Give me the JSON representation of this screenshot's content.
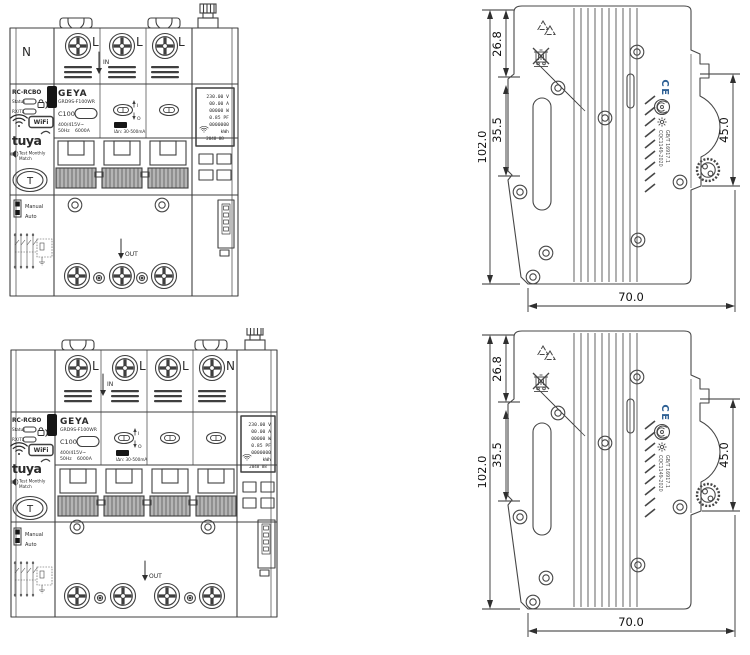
{
  "drawing": {
    "background": "#ffffff",
    "line_color": "#3f3f3f",
    "ce_color": "#2e6094"
  },
  "device1": {
    "description": "front-view-3-pole-rcbo",
    "terminals": [
      "N",
      "L",
      "L",
      "L"
    ],
    "in_label": "IN",
    "out_label": "OUT",
    "side_panel": {
      "title": "RC-RCBO",
      "status_label": "Status",
      "rxtx_label": "RX/TX",
      "wifi_badge": "WiFi",
      "tuya_logo": "tuya",
      "test_line1": "Test Monthly",
      "test_line2": "Match",
      "test_button": "T",
      "manual_label": "Manual",
      "auto_label": "Auto"
    },
    "nameplate": {
      "brand": "GEYA",
      "model": "GRD9S-F100WR",
      "rating": "C100",
      "voltage": "400/415V~",
      "frequency": "50Hz",
      "breaking_capacity": "6000A",
      "residual_current": "IΔn: 30-500mA",
      "on_mark": "I",
      "off_mark": "O"
    },
    "lcd": {
      "line1": "230.00 V",
      "line2": "00.00 A",
      "line3": "00000 W",
      "line4": "0.85 PF",
      "line5": "0000000",
      "line6": "kWh",
      "line7": "2048 88"
    }
  },
  "device2": {
    "description": "front-view-4-pole-rcbo",
    "terminals": [
      "L",
      "L",
      "L",
      "N"
    ],
    "in_label": "IN",
    "out_label": "OUT",
    "side_panel": {
      "title": "RC-RCBO",
      "status_label": "Status",
      "rxtx_label": "RX/TX",
      "wifi_badge": "WiFi",
      "tuya_logo": "tuya",
      "test_line1": "Test Monthly",
      "test_line2": "Match",
      "test_button": "T",
      "manual_label": "Manual",
      "auto_label": "Auto"
    },
    "nameplate": {
      "brand": "GEYA",
      "model": "GRD9S-F100WR",
      "rating": "C100",
      "voltage": "400/415V~",
      "frequency": "50Hz",
      "breaking_capacity": "6000A",
      "residual_current": "IΔn: 30-500mA",
      "on_mark": "I",
      "off_mark": "O"
    },
    "lcd": {
      "line1": "230.00 V",
      "line2": "00.00 A",
      "line3": "00000 W",
      "line4": "0.85 PF",
      "line5": "0000000",
      "line6": "kWh",
      "line7": "2048 88"
    }
  },
  "side1": {
    "dim_height": "102.0",
    "dim_upper": "26.8",
    "dim_lower": "35.5",
    "dim_right": "45.0",
    "dim_depth": "70.0",
    "ce_mark": "CE",
    "cert_line1": "CQC1149-2020",
    "cert_line2": "GB/T 16917.1"
  },
  "side2": {
    "dim_height": "102.0",
    "dim_upper": "26.8",
    "dim_lower": "35.5",
    "dim_right": "45.0",
    "dim_depth": "70.0",
    "ce_mark": "CE",
    "cert_line1": "CQC1149-2020",
    "cert_line2": "GB/T 16917.1"
  }
}
